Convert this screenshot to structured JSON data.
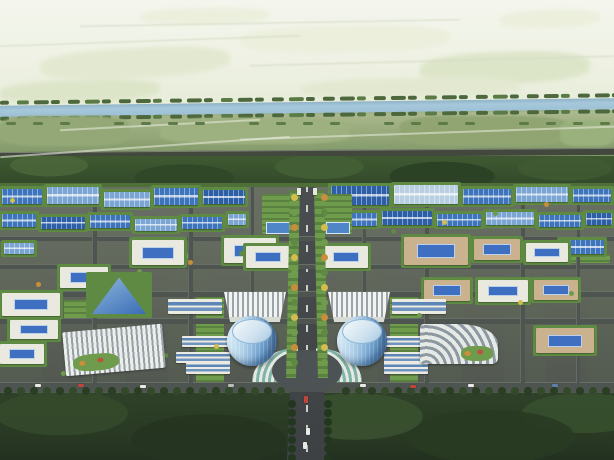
{
  "meta": {
    "description": "Bird's-eye architectural rendering of a planned industrial park: hazy farmland and a tree-lined river to the north, a grid of blue-roofed factory halls and white courtyard office blocks, a central north-south axis boulevard flanked by twin cylindrical glass towers and fan-roofed halls, a semicircular flower plaza, landmark ribbed exhibition halls east and west, and a dense forest belt across the south.",
    "width": 614,
    "height": 460
  },
  "palette": {
    "skyPatch": {
      "p1": "#e3e9d1",
      "p2": "#dde5c9",
      "p3": "#ebefdc"
    },
    "skyLine": "rgba(210,218,195,0.5)",
    "riverTree": "#4c683c",
    "riverTreeLight": "#5a7a46",
    "fieldTree": "#5d7a48",
    "roof": {
      "a": "#3d74bb",
      "b": "#7ba6d4",
      "c": "#2d5fa6",
      "d": "#b9cfe2"
    },
    "wall": {
      "white": "#eae9df",
      "tan": "#c9b28d"
    },
    "axisTrees": [
      "#d2bd4e",
      "#6f9b4d",
      "#c98e3c",
      "#5f8a43"
    ],
    "forestTree": "#23361f",
    "roadTree": [
      "#2a3e23",
      "#334a2a"
    ],
    "car": {
      "white": "#e9eae6",
      "red": "#c0463a",
      "blue": "#5b80ae",
      "silver": "#b9bdb9"
    }
  },
  "sky": {
    "patches": [
      [
        40,
        48,
        190,
        30,
        -3,
        "p1"
      ],
      [
        240,
        26,
        210,
        26,
        -1,
        "p3"
      ],
      [
        420,
        52,
        170,
        32,
        -2,
        "p2"
      ],
      [
        140,
        8,
        130,
        16,
        -1,
        "p3"
      ],
      [
        0,
        80,
        160,
        22,
        -2,
        "p2"
      ],
      [
        300,
        78,
        220,
        20,
        -1,
        "p1"
      ],
      [
        500,
        10,
        100,
        18,
        -2,
        "p3"
      ]
    ],
    "lines": [
      [
        0,
        40,
        300,
        -2
      ],
      [
        250,
        60,
        364,
        -1.5
      ],
      [
        80,
        22,
        380,
        -1
      ]
    ]
  },
  "river": {
    "x": -2,
    "y": 97,
    "w": 620,
    "h": 22,
    "bodyY": 5,
    "bodyH": 11,
    "dashRows": [
      0,
      16
    ],
    "dashStep": 17
  },
  "fieldTrees": {
    "y": 122,
    "step": 27,
    "count": 23
  },
  "fields": {
    "patches": [
      [
        0,
        116,
        130,
        30,
        "#93a876"
      ],
      [
        160,
        118,
        190,
        26,
        "#9db07f"
      ],
      [
        400,
        116,
        170,
        30,
        "#90a572"
      ],
      [
        560,
        120,
        54,
        26,
        "#9ab17e"
      ]
    ],
    "paths": [
      [
        0,
        146,
        290,
        -4
      ],
      [
        240,
        132,
        380,
        -2
      ],
      [
        60,
        124,
        200,
        -3
      ]
    ],
    "pathColor": "#e2e7d6"
  },
  "highway": [
    0,
    150,
    616,
    6
  ],
  "park": {
    "hedgeTop": [
      0,
      183,
      614,
      4
    ],
    "greens": [
      [
        196,
        296,
        28,
        88
      ],
      [
        390,
        296,
        28,
        88
      ],
      [
        150,
        252,
        40,
        9
      ],
      [
        478,
        252,
        52,
        9
      ],
      [
        64,
        300,
        26,
        24
      ],
      [
        560,
        254,
        50,
        9
      ]
    ],
    "roadsH": [
      [
        0,
        236,
        614,
        4
      ],
      [
        0,
        264,
        614,
        4
      ],
      [
        0,
        291,
        614,
        5
      ],
      [
        0,
        318,
        614,
        5
      ],
      [
        0,
        382,
        614,
        9
      ]
    ],
    "roadsV": [
      [
        92,
        187,
        4,
        196
      ],
      [
        188,
        187,
        4,
        196
      ],
      [
        250,
        187,
        3,
        150
      ],
      [
        362,
        187,
        3,
        150
      ],
      [
        424,
        187,
        4,
        196
      ],
      [
        520,
        187,
        4,
        196
      ],
      [
        576,
        187,
        3,
        196
      ]
    ],
    "factories": [
      [
        2,
        189,
        40,
        15,
        "a"
      ],
      [
        47,
        187,
        52,
        17,
        "b"
      ],
      [
        104,
        192,
        46,
        15,
        "b"
      ],
      [
        154,
        188,
        44,
        17,
        "a"
      ],
      [
        203,
        190,
        42,
        14,
        "c"
      ],
      [
        331,
        186,
        58,
        19,
        "c"
      ],
      [
        394,
        185,
        64,
        19,
        "d"
      ],
      [
        463,
        189,
        48,
        15,
        "a"
      ],
      [
        516,
        187,
        52,
        15,
        "b"
      ],
      [
        573,
        189,
        38,
        13,
        "a"
      ],
      [
        2,
        214,
        34,
        13,
        "a"
      ],
      [
        41,
        217,
        44,
        12,
        "c"
      ],
      [
        90,
        215,
        40,
        13,
        "a"
      ],
      [
        135,
        219,
        42,
        12,
        "b"
      ],
      [
        182,
        217,
        40,
        12,
        "a"
      ],
      [
        228,
        214,
        18,
        11,
        "b"
      ],
      [
        331,
        213,
        46,
        13,
        "a"
      ],
      [
        382,
        211,
        50,
        14,
        "c"
      ],
      [
        437,
        214,
        44,
        12,
        "a"
      ],
      [
        486,
        212,
        48,
        13,
        "b"
      ],
      [
        539,
        215,
        42,
        12,
        "a"
      ],
      [
        586,
        213,
        26,
        12,
        "c"
      ],
      [
        4,
        243,
        30,
        11,
        "b"
      ],
      [
        560,
        240,
        44,
        14,
        "a"
      ]
    ],
    "courtyards": [
      [
        132,
        240,
        52,
        25,
        "white"
      ],
      [
        224,
        238,
        52,
        25,
        "white"
      ],
      [
        60,
        267,
        48,
        21,
        "white"
      ],
      [
        2,
        293,
        58,
        23,
        "white"
      ],
      [
        10,
        320,
        48,
        19,
        "white"
      ],
      [
        0,
        344,
        44,
        20,
        "white"
      ],
      [
        404,
        237,
        64,
        28,
        "tan"
      ],
      [
        474,
        239,
        46,
        21,
        "tan"
      ],
      [
        526,
        243,
        42,
        19,
        "white"
      ],
      [
        424,
        280,
        46,
        21,
        "tan"
      ],
      [
        478,
        280,
        50,
        22,
        "white"
      ],
      [
        534,
        280,
        44,
        20,
        "tan"
      ],
      [
        536,
        328,
        58,
        25,
        "tan"
      ],
      [
        246,
        246,
        44,
        22,
        "white"
      ],
      [
        324,
        246,
        44,
        22,
        "white"
      ]
    ],
    "offices": [
      [
        168,
        299,
        54,
        15
      ],
      [
        182,
        336,
        46,
        11
      ],
      [
        176,
        352,
        54,
        11
      ],
      [
        392,
        299,
        54,
        15
      ],
      [
        386,
        336,
        46,
        11
      ],
      [
        384,
        352,
        54,
        11
      ],
      [
        186,
        362,
        44,
        12
      ],
      [
        384,
        362,
        44,
        12
      ]
    ],
    "gardens": {
      "plots": [
        [
          262,
          194,
          32,
          40
        ],
        [
          320,
          194,
          32,
          40
        ]
      ],
      "pools": [
        [
          266,
          222,
          22,
          10
        ],
        [
          326,
          222,
          22,
          10
        ]
      ]
    },
    "treeDots": {
      "count": 22
    },
    "landmarks": {
      "triangle": [
        92,
        276,
        54,
        38
      ],
      "stripeHall": [
        64,
        328,
        100,
        44,
        -5
      ],
      "curveHall": [
        420,
        324,
        78,
        40
      ],
      "fans": [
        [
          224,
          292,
          62,
          30
        ],
        [
          328,
          292,
          62,
          30
        ]
      ],
      "towers": [
        [
          227,
          316,
          50,
          50
        ],
        [
          337,
          316,
          50,
          50
        ]
      ],
      "plazaDisc": [
        272,
        350,
        70,
        42
      ]
    }
  },
  "axis": {
    "rect": [
      276,
      185,
      62,
      275
    ],
    "topX": [
      23,
      39
    ],
    "bottomX": [
      11,
      51
    ],
    "flanks": [
      [
        288,
        190,
        10,
        188
      ],
      [
        316,
        190,
        10,
        188
      ]
    ],
    "trees": {
      "start": 194,
      "step": 15,
      "count": 12,
      "lx": 291,
      "rx": 321
    },
    "forestTrees": {
      "start": 400,
      "step": 9,
      "count": 7,
      "lx": 288,
      "rx": 324
    },
    "gatePosts": [
      [
        297,
        188,
        4,
        7
      ],
      [
        313,
        188,
        4,
        7
      ]
    ],
    "cars": [
      [
        304,
        396,
        "red"
      ],
      [
        306,
        428,
        "white"
      ],
      [
        303,
        442,
        "white"
      ]
    ]
  },
  "plaza": {
    "terraces": [
      [
        252,
        348,
        46,
        34,
        "L"
      ],
      [
        316,
        348,
        46,
        34,
        "R"
      ]
    ],
    "flowers": [
      [
        284,
        358,
        16,
        16
      ],
      [
        314,
        358,
        16,
        16
      ]
    ]
  },
  "roadTrees": {
    "y": 387,
    "step": 13,
    "skip": [
      278,
      336
    ]
  },
  "cars": [
    [
      35,
      384,
      "white"
    ],
    [
      78,
      384,
      "red"
    ],
    [
      140,
      385,
      "white"
    ],
    [
      228,
      384,
      "silver"
    ],
    [
      360,
      384,
      "white"
    ],
    [
      410,
      385,
      "red"
    ],
    [
      468,
      384,
      "white"
    ],
    [
      552,
      384,
      "blue"
    ]
  ]
}
